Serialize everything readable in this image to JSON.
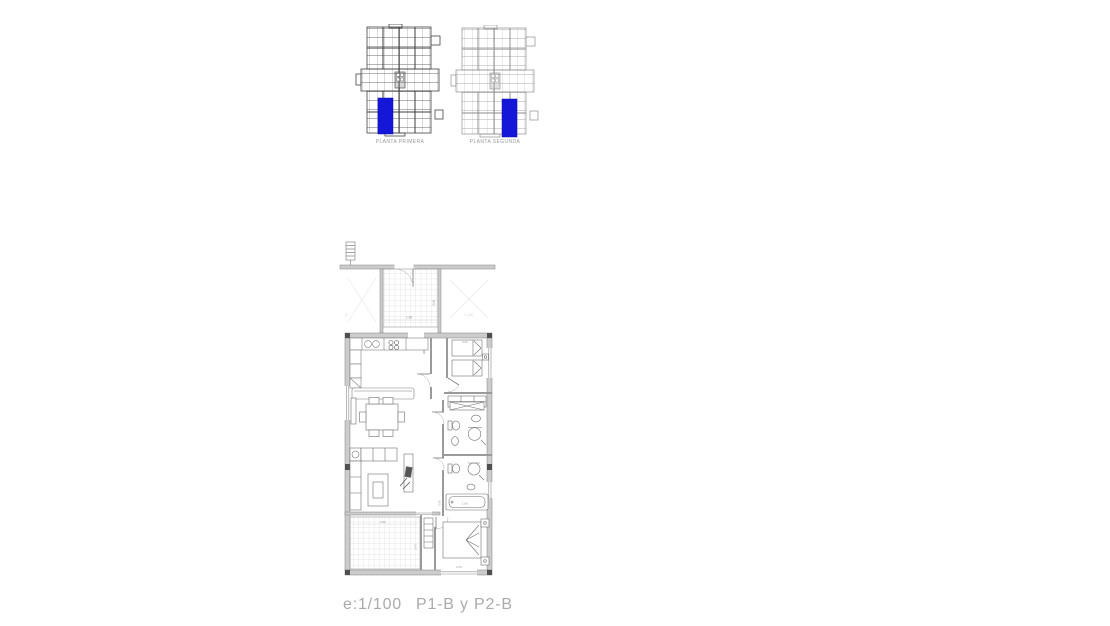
{
  "overview": {
    "highlight_color": "#1517d8",
    "plans": [
      {
        "label": "PLANTA PRIMERA"
      },
      {
        "label": "PLANTA SEGUNDA"
      }
    ]
  },
  "floorplan": {
    "dims": {
      "terrace_width": "2.86",
      "terrace_depth": "3.00",
      "entry_width": "1.35",
      "bedroom1_width": "3.00",
      "tub_length": "1.80",
      "bath_width": "0.90",
      "terrace2_width": "3.86",
      "terrace2_depth": "3.50",
      "bedroom2_width": "2.53"
    },
    "notes": {
      "left_mark": "D",
      "window_note": "V (26)"
    }
  },
  "footer": {
    "scale": "e:1/100",
    "plans": "P1-B y P2-B"
  }
}
